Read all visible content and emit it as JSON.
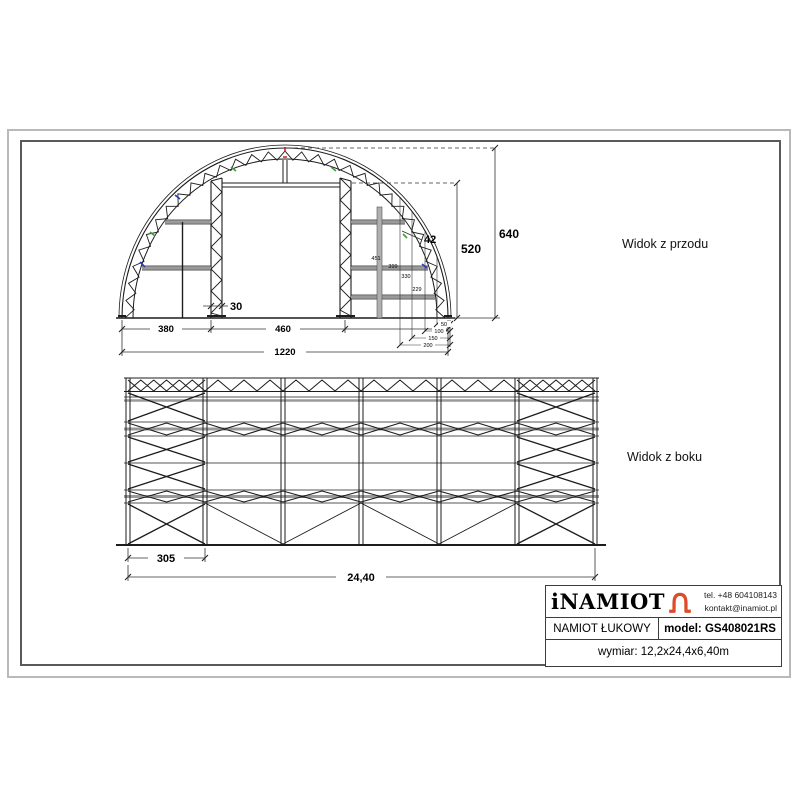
{
  "front_view": {
    "label": "Widok z przodu",
    "dims": {
      "left_bay": "380",
      "door_width": "460",
      "total_width": "1220",
      "post_width": "30",
      "arch_thickness": "42",
      "door_height": "520",
      "apex_height": "640",
      "rail_heights": [
        "451",
        "399",
        "330",
        "229"
      ],
      "base_offsets": [
        "50",
        "100",
        "150",
        "200"
      ]
    }
  },
  "side_view": {
    "label": "Widok z boku",
    "dims": {
      "first_bay": "305",
      "total_length": "24,40"
    }
  },
  "title_block": {
    "brand": "iNAMIOT",
    "phone": "tel. +48 604108143",
    "email": "kontakt@inamiot.pl",
    "product": "NAMIOT ŁUKOWY",
    "model": "model: GS408021RS",
    "dimensions": "wymiar: 12,2x24,4x6,40m"
  },
  "colors": {
    "logo_orange": "#DD4B28",
    "mark_red": "#CC2020",
    "mark_green": "#3A9E3A",
    "mark_blue": "#2B3BC0"
  }
}
